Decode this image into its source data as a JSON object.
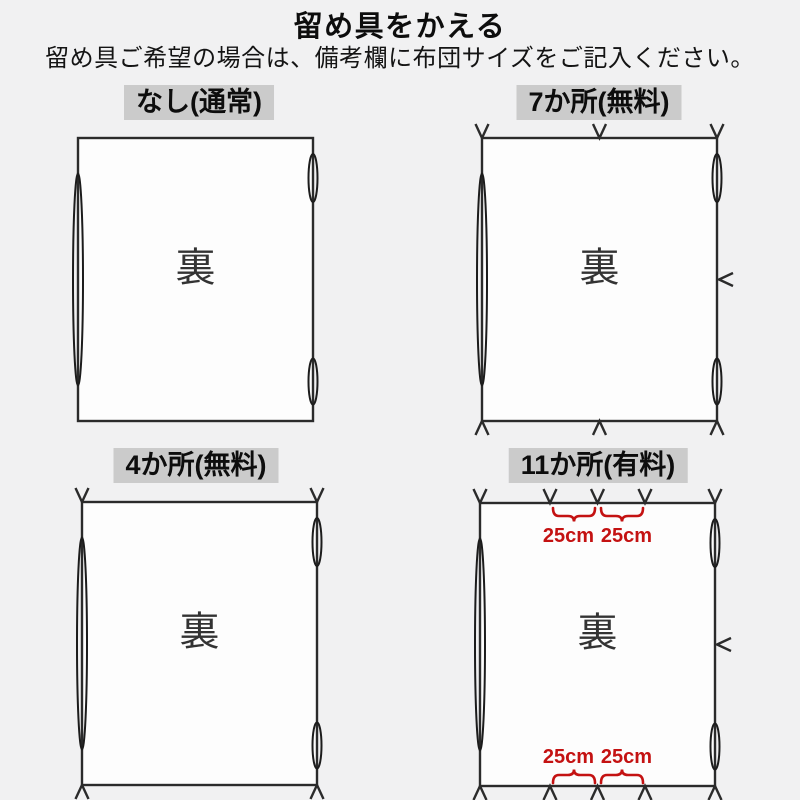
{
  "page": {
    "title": "留め具をかえる",
    "subtitle": "留め具ご希望の場合は、備考欄に布団サイズをご記入ください。"
  },
  "panels": [
    {
      "id": "none",
      "label": "なし(通常)",
      "back_label": "裏",
      "fastener_count": 0
    },
    {
      "id": "seven",
      "label": "7か所(無料)",
      "back_label": "裏",
      "fastener_count": 7
    },
    {
      "id": "four",
      "label": "4か所(無料)",
      "back_label": "裏",
      "fastener_count": 4
    },
    {
      "id": "eleven",
      "label": "11か所(有料)",
      "back_label": "裏",
      "fastener_count": 11,
      "measurements": {
        "top": [
          "25cm",
          "25cm"
        ],
        "bottom": [
          "25cm",
          "25cm"
        ]
      }
    }
  ],
  "colors": {
    "page_bg": "#f1f1f2",
    "label_bg": "#cbcbcb",
    "outline": "#2b2b2b",
    "accent_red": "#c41212"
  }
}
